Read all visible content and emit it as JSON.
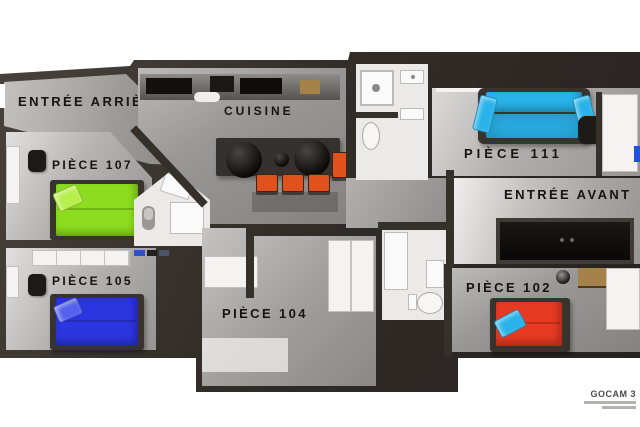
{
  "plan": {
    "view": "Plan appartement 3D vue de dessus",
    "rooms": {
      "entree_arriere": {
        "label": "Entrée Arrière"
      },
      "cuisine": {
        "label": "Cuisine"
      },
      "piece_107": {
        "label": "Pièce 107",
        "bed_color": "#8cdd1f",
        "pillow_color": "#b7ef4d"
      },
      "piece_105": {
        "label": "Pièce 105",
        "bed_color": "#2b35e0",
        "pillow_color": "#5560ee"
      },
      "piece_104": {
        "label": "Pièce 104"
      },
      "piece_111": {
        "label": "Pièce 111",
        "sofa_color": "#29b3ea"
      },
      "entree_avant": {
        "label": "Entrée Avant"
      },
      "piece_102": {
        "label": "Pièce 102",
        "bed_color": "#e73a22",
        "pillow_color": "#2ab2ea"
      }
    },
    "accent_colors": {
      "chair_orange": "#e0511c",
      "counter_gold": "#a5824a",
      "wall_dark": "#36302a"
    },
    "watermark": {
      "brand": "GOCAM 3"
    }
  }
}
